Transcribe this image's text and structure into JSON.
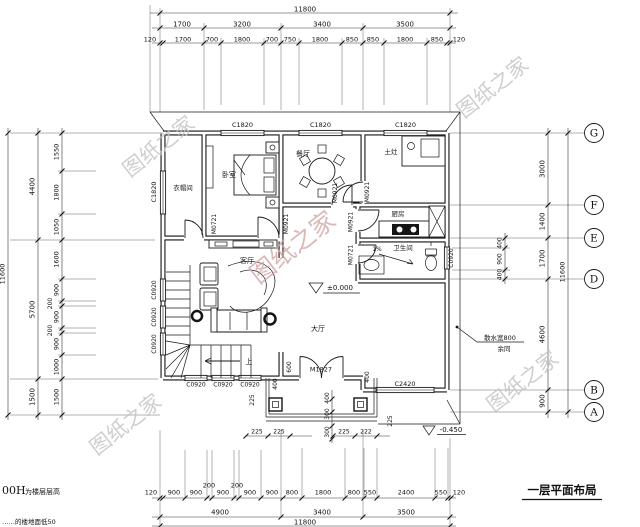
{
  "title": "一层平面布局",
  "watermark": "图纸之家",
  "notes": {
    "prefix": "00H",
    "line1": "为楼层层高",
    "line2": "……的楼地面低50"
  },
  "rooms": {
    "cloakroom": "衣帽间",
    "bedroom": "卧室",
    "dining": "餐厅",
    "stove_room": "土灶",
    "kitchen": "厨房",
    "bathroom": "卫生间",
    "living": "客厅",
    "hall": "大厅"
  },
  "labels": {
    "up": "上",
    "slope": "1%",
    "elev_zero": "±0.000",
    "elev_neg": "-0.450",
    "apron1": "散水宽800",
    "apron2": "余同"
  },
  "openings": {
    "c1820": "C1820",
    "c0920": "C0920",
    "c2420": "C2420",
    "m0721": "M0721",
    "m0921": "M0921",
    "m1827": "M1827"
  },
  "grid": [
    "G",
    "F",
    "E",
    "D",
    "B",
    "A"
  ],
  "dims": {
    "top1": "11800",
    "top2": [
      "1700",
      "3200",
      "3400",
      "3500"
    ],
    "top3": [
      "120",
      "1700",
      "700",
      "1800",
      "700",
      "750",
      "1800",
      "850",
      "850",
      "1800",
      "850",
      "120"
    ],
    "bottom1": [
      "120",
      "900",
      "900",
      "200",
      "900",
      "200",
      "900",
      "900",
      "800",
      "1800",
      "800",
      "550",
      "2400",
      "550",
      "120"
    ],
    "bottom2": [
      "4900",
      "3400",
      "3500"
    ],
    "bottom3": "11800",
    "left_outer": "11600",
    "left_mid": [
      "4400",
      "5700",
      "1500"
    ],
    "left_inner": [
      "1550",
      "1800",
      "1050",
      "1600",
      "900",
      "200",
      "900",
      "200",
      "900",
      "1000",
      "1500"
    ],
    "right_outer": "11600",
    "right_mid": [
      "3000",
      "1400",
      "1700",
      "4600",
      "900"
    ],
    "right_inner": [
      "400",
      "900",
      "400"
    ],
    "porch": {
      "d600": "600",
      "d400": "400",
      "d300": "300",
      "d225": "225",
      "d222": "222"
    }
  }
}
